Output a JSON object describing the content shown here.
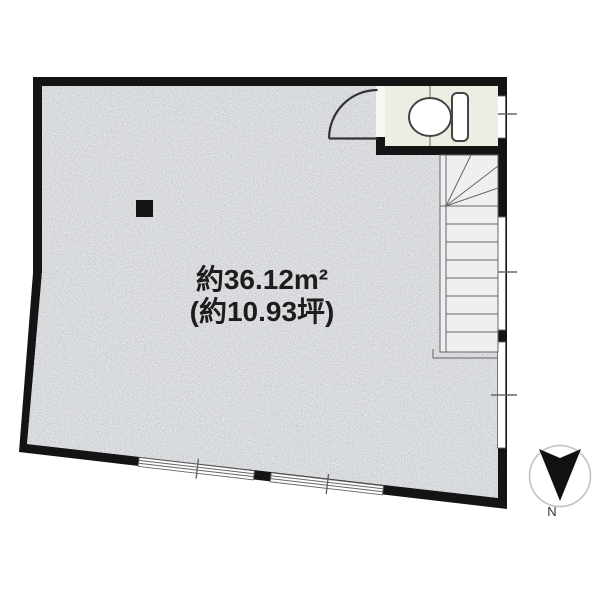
{
  "floor_plan": {
    "area_label": {
      "line1": "約36.12m²",
      "line2": "(約10.93坪)"
    },
    "compass": {
      "label": "N"
    },
    "features": [
      "toilet-icon",
      "staircase",
      "door-swing",
      "sliding-windows",
      "pillar",
      "north-arrow"
    ]
  },
  "colors": {
    "background": "#ffffff",
    "wall": "#141414",
    "floor": "#d3d6da",
    "toilet_floor": "#eeede4",
    "stair_floor": "#edeff0",
    "window_glass": "#ffffff",
    "line": "#666666",
    "compass_ring": "#bfbfbf"
  }
}
